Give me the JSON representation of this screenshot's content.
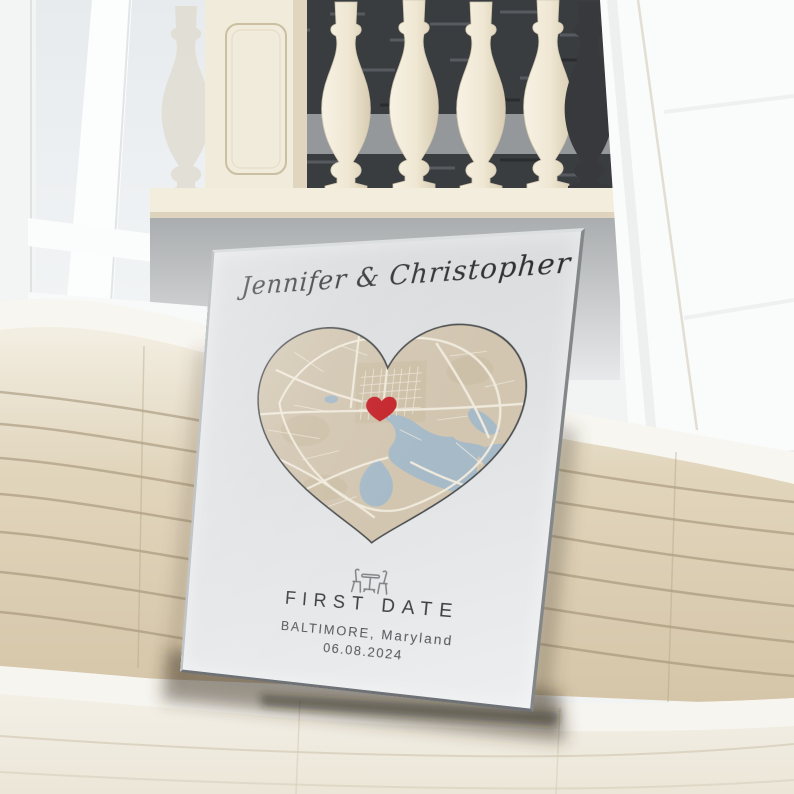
{
  "poster": {
    "title": "Jennifer & Christopher",
    "event_label": "FIRST DATE",
    "location": "BALTIMORE, Maryland",
    "date": "06.08.2024",
    "frame_color": "#9aa0a3",
    "background_color": "#e0e2e4",
    "icon": "table-chairs-icon",
    "map": {
      "shape": "heart",
      "land_color": "#d2c6b1",
      "water_color": "#a6bac8",
      "road_color": "#f0eadd",
      "downtown_patch_color": "#c7b99f",
      "outline_color": "#4a4c4e",
      "marker_icon": "heart-marker-icon",
      "marker_color": "#c5242b"
    }
  },
  "scene": {
    "window_frame_color": "#fcfdfd",
    "glass_color": "#e9edf0",
    "baluster_color": "#f2ebdb",
    "balustrade_backdrop_color": "#3a3d40",
    "stone_rail_color": "#f3eddd",
    "right_wall_color": "#fafbfb",
    "couch_back_color": "#d9c9ac",
    "couch_seat_color": "#f2efe7"
  }
}
